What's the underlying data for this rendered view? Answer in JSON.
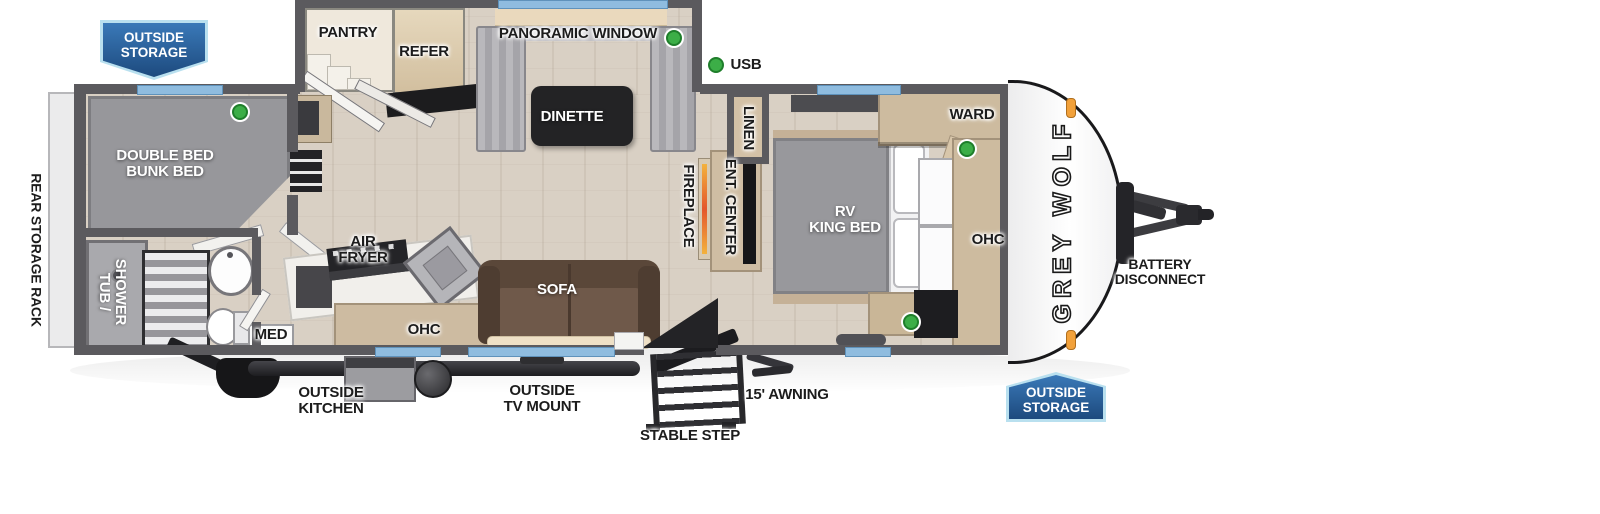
{
  "legend": {
    "usb": "USB"
  },
  "badges": {
    "top_left": "OUTSIDE\nSTORAGE",
    "bottom_right": "OUTSIDE\nSTORAGE"
  },
  "brand": {
    "logo": "GREY WOLF"
  },
  "exterior": {
    "battery_disconnect": "BATTERY\nDISCONNECT",
    "outside_kitchen": "OUTSIDE\nKITCHEN",
    "outside_tv_mount": "OUTSIDE\nTV MOUNT",
    "stable_step": "STABLE STEP",
    "awning": "15' AWNING",
    "rear_storage_rack": "REAR STORAGE RACK"
  },
  "rooms": {
    "pantry": "PANTRY",
    "refer": "REFER",
    "panoramic_window": "PANORAMIC WINDOW",
    "dinette": "DINETTE",
    "bunk_bed": "DOUBLE BED\nBUNK BED",
    "tub_shower": "TUB /\nSHOWER",
    "med": "MED",
    "air_fryer": "AIR\nFRYER",
    "ohc_kitchen": "OHC",
    "sofa": "SOFA",
    "fireplace": "FIREPLACE",
    "ent_center": "ENT. CENTER",
    "linen": "LINEN",
    "ward": "WARD",
    "rv_king_bed": "RV\nKING BED",
    "ohc_bedroom": "OHC"
  },
  "colors": {
    "badge_blue": "#2a5d9b",
    "badge_border": "#b9e0ef",
    "usb_green": "#3cae47",
    "window_blue": "#8fbcdf",
    "wall_gray": "#5b5a5e"
  }
}
